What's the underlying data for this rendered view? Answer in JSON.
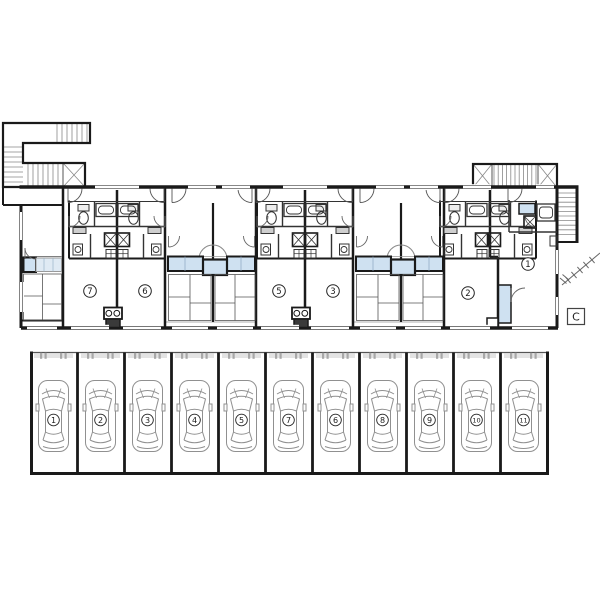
{
  "drawing": {
    "type": "apartment-floor-plan-with-parking",
    "floor_plan": {
      "unit_labels": [
        {
          "label": "7"
        },
        {
          "label": "6"
        },
        {
          "label": "5"
        },
        {
          "label": "3"
        },
        {
          "label": "2"
        },
        {
          "label": "1"
        }
      ],
      "section_marker": "C"
    },
    "parking": {
      "stall_labels": [
        {
          "label": "1"
        },
        {
          "label": "2"
        },
        {
          "label": "3"
        },
        {
          "label": "4"
        },
        {
          "label": "5"
        },
        {
          "label": "7"
        },
        {
          "label": "6"
        },
        {
          "label": "8"
        },
        {
          "label": "9"
        },
        {
          "label": "10"
        },
        {
          "label": "11"
        }
      ]
    },
    "colors": {
      "wall": "#1a1a1a",
      "thin_line": "#555555",
      "light_line": "#999999",
      "water_blue": "#cfe1f1",
      "pale_blue": "#dfeaf4",
      "fixture_gray": "#cfcfcf",
      "car_outline": "#909090",
      "tick_gray": "#a8a8a8",
      "background": "#ffffff"
    }
  }
}
